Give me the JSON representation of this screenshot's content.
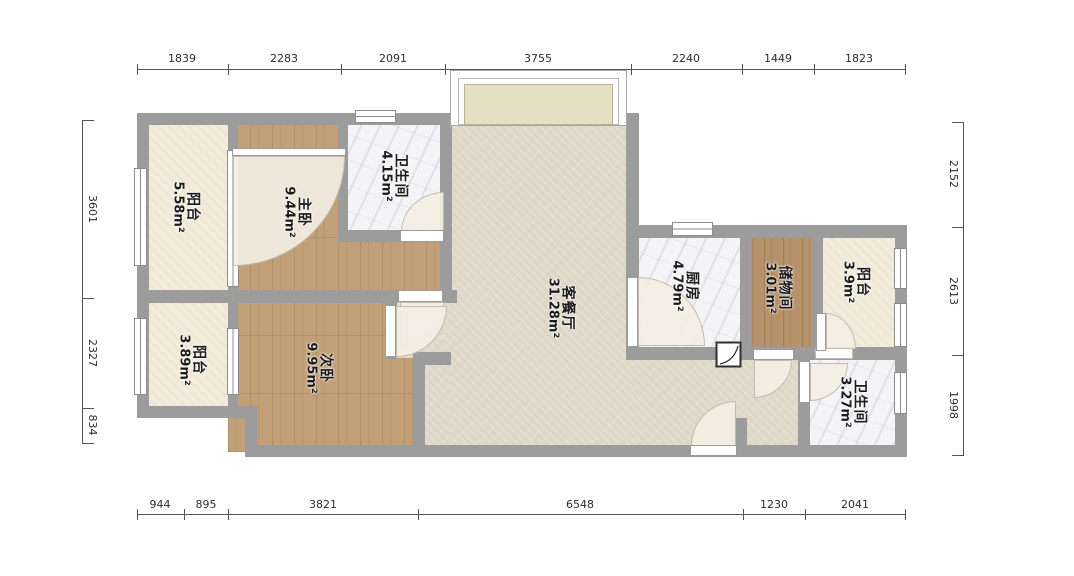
{
  "rooms": [
    {
      "name": "阳台",
      "area": "5.58m²"
    },
    {
      "name": "主卧",
      "area": "9.44m²"
    },
    {
      "name": "卫生间",
      "area": "4.15m²"
    },
    {
      "name": "客餐厅",
      "area": "31.28m²"
    },
    {
      "name": "厨房",
      "area": "4.79m²"
    },
    {
      "name": "储物间",
      "area": "3.01m²"
    },
    {
      "name": "阳台",
      "area": "3.9m²"
    },
    {
      "name": "阳台",
      "area": "3.89m²"
    },
    {
      "name": "次卧",
      "area": "9.95m²"
    },
    {
      "name": "卫生间",
      "area": "3.27m²"
    }
  ],
  "dims": {
    "top": [
      "1839",
      "2283",
      "2091",
      "3755",
      "2240",
      "1449",
      "1823"
    ],
    "bottom": [
      "944",
      "895",
      "3821",
      "6548",
      "1230",
      "2041"
    ],
    "left": [
      "3601",
      "2327",
      "834"
    ],
    "right": [
      "2152",
      "2613",
      "1998"
    ]
  },
  "colors": {
    "wall": "#9c9c9c",
    "living_floor": "#e1dbcc",
    "wood_floor": "#c2a077",
    "marble_floor": "#f4f4f6",
    "balcony_floor": "#f2ecdc",
    "bay_sill": "#e7dfc3"
  },
  "icons": {
    "pipe_shaft": "pipe-shaft-icon"
  }
}
